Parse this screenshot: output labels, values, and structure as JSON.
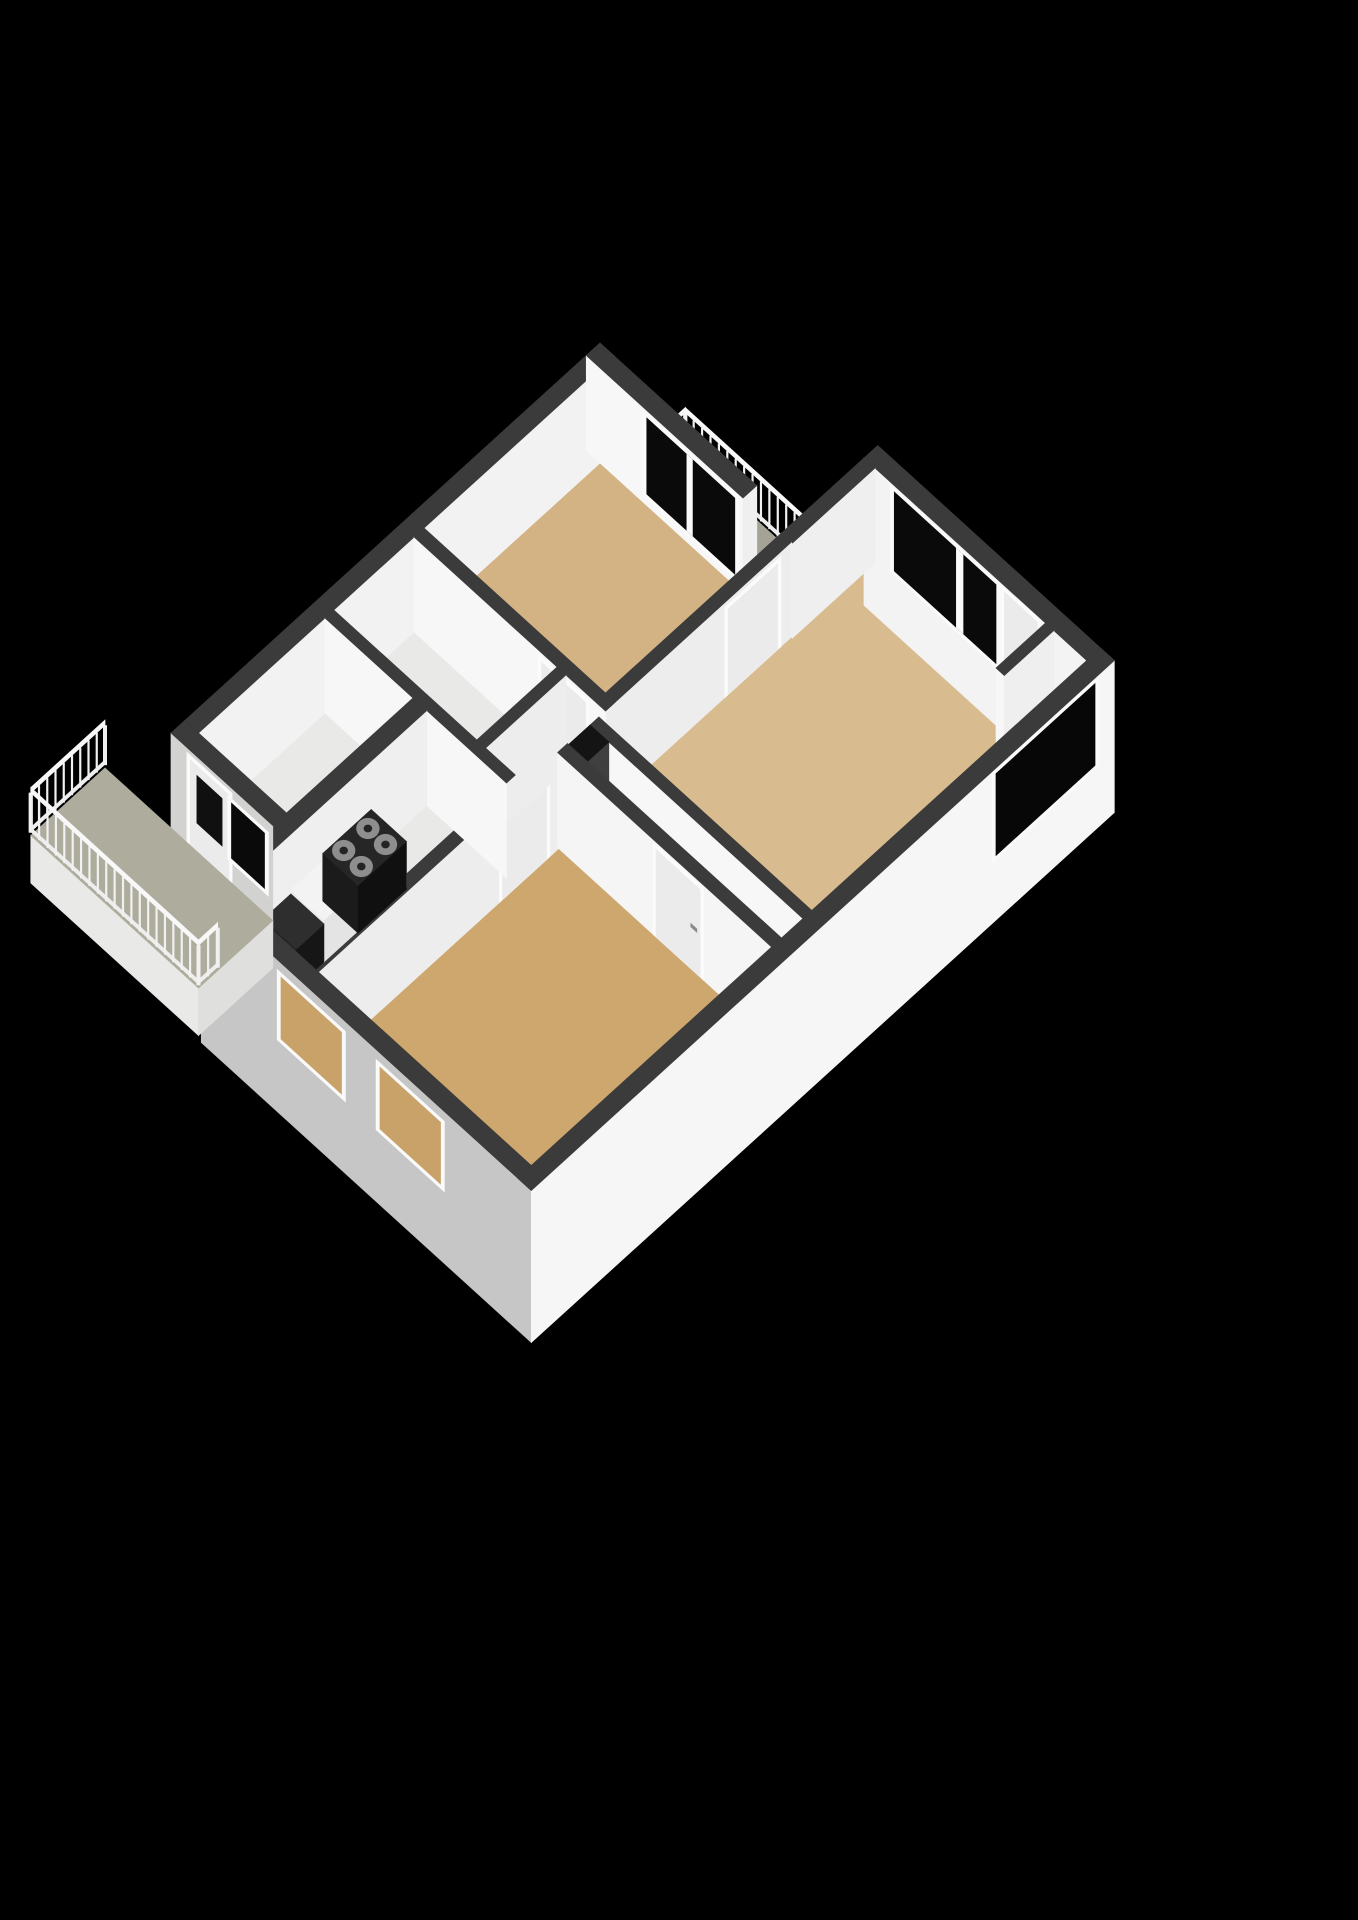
{
  "meta": {
    "kind": "3d-floor-plan-rendering",
    "background_color": "#000000",
    "canvas_width": 1358,
    "canvas_height": 1920,
    "style": "isometric cutaway apartment floor plan, white walls with dark-gray cut tops, tan wood floors, black background, no text labels"
  },
  "scene_description": {
    "rooms": [
      {
        "id": "bedroom-1",
        "floor_color": "#d3b383",
        "features": [
          "window-wall to top balcony"
        ]
      },
      {
        "id": "living-room",
        "floor_color": "#d8bb8e",
        "features": [
          "large dark window",
          "balcony door",
          "niche"
        ]
      },
      {
        "id": "hall",
        "floor_color": "#cfa976",
        "features": [
          "entrance door",
          "shaft"
        ]
      },
      {
        "id": "bedroom-2",
        "floor_color": "#cda76e",
        "features": [
          "two windows in sw facade"
        ]
      },
      {
        "id": "kitchen",
        "floor_color": "#e9e9e7",
        "features": [
          "counter",
          "4-burner stove",
          "dark worktop"
        ]
      },
      {
        "id": "bathroom",
        "floor_color": "#e9e9e7",
        "features": []
      },
      {
        "id": "toilet",
        "floor_color": "#e9e9e7",
        "features": []
      },
      {
        "id": "utility-room",
        "floor_color": "#e9e9e7",
        "features": [
          "door and window to sw balcony"
        ]
      },
      {
        "id": "balcony-top",
        "floor_color": "#a5a396",
        "features": [
          "white baluster railing"
        ]
      },
      {
        "id": "balcony-sw",
        "floor_color": "#aeac9d",
        "features": [
          "white baluster railing on three sides"
        ]
      }
    ]
  },
  "palette": {
    "background": "#000000",
    "wall_top": "#3b3b3b",
    "wall_inner_bright": "#f7f7f7",
    "wall_inner_dim": "#ededed",
    "wall_exterior_light": "#f6f6f6",
    "wall_exterior_gray": "#c6c6c6",
    "floor_tan": "#d3b383",
    "floor_gray": "#e9e9e7",
    "balcony_floor": "#aeac9d",
    "window_glass": "#0a0a0a",
    "window_tan_glass": "#c9a269",
    "frame_white": "#fafafa",
    "door_panel": "#ebebeb",
    "railing": "#f1f1f1",
    "stove_body": "#1b1b1b",
    "burner": "#8e8e8e"
  },
  "render": {
    "projection": {
      "origin_x": 600,
      "origin_y": 463,
      "ax": 55,
      "ay": 50,
      "wall_px": 95
    },
    "rail_height": 0.45,
    "elements": [
      {
        "t": "face",
        "side": "v",
        "at": -0.85,
        "a": [
          0.7,
          3.3
        ],
        "z": [
          -0.45,
          0
        ],
        "c": "#e9e9e7",
        "name": "balcony-top-fascia"
      },
      {
        "t": "face",
        "side": "u",
        "at": 3.3,
        "a": [
          -0.85,
          0
        ],
        "z": [
          -0.45,
          0
        ],
        "c": "#dcdcda",
        "name": "balcony-top-fascia-side"
      },
      {
        "t": "floor",
        "r": [
          0.7,
          -0.85,
          3.3,
          0
        ],
        "c": "#a5a396",
        "name": "balcony-top-floor"
      },
      {
        "t": "rail",
        "a": [
          0.7,
          -0.85
        ],
        "b": [
          0.7,
          0
        ],
        "name": "balcony-top-railing-nw"
      },
      {
        "t": "rail",
        "a": [
          0.7,
          -0.85
        ],
        "b": [
          3.3,
          -0.85
        ],
        "name": "balcony-top-railing-ne"
      },
      {
        "t": "floor",
        "r": [
          0,
          0,
          3.3,
          3.2
        ],
        "c": "#d3b383",
        "name": "bedroom-1-floor"
      },
      {
        "t": "floor",
        "r": [
          3.48,
          -1.5,
          7.35,
          3.5
        ],
        "c": "#d8bb8e",
        "name": "living-room-floor"
      },
      {
        "t": "floor",
        "r": [
          6.75,
          -1.5,
          7.35,
          -0.6
        ],
        "c": "#e3e3e1",
        "name": "living-room-niche-floor"
      },
      {
        "t": "floor",
        "r": [
          0,
          3.38,
          2.6,
          4.84
        ],
        "c": "#e9e9e7",
        "name": "bathroom-floor"
      },
      {
        "t": "floor",
        "r": [
          2.76,
          3.38,
          3.3,
          4.84
        ],
        "c": "#e9e9e7",
        "name": "toilet-floor"
      },
      {
        "t": "floor",
        "r": [
          0,
          5.0,
          1.6,
          7.3
        ],
        "c": "#e9e9e7",
        "name": "utility-room-floor"
      },
      {
        "t": "floor",
        "r": [
          1.85,
          5.0,
          3.3,
          8.6
        ],
        "c": "#e9e9e7",
        "name": "kitchen-floor"
      },
      {
        "t": "floor",
        "r": [
          3.48,
          3.38,
          7.35,
          4.05
        ],
        "c": "#cfa976",
        "name": "hall-floor"
      },
      {
        "t": "floor",
        "r": [
          3.48,
          4.23,
          7.35,
          8.6
        ],
        "c": "#cda76e",
        "name": "bedroom-2-floor"
      },
      {
        "t": "block",
        "r": [
          -0.25,
          -0.25,
          0,
          7.3
        ],
        "z": [
          0,
          1
        ],
        "su": "#f2f2f2",
        "top": "#3b3b3b",
        "name": "wall-nw-exterior"
      },
      {
        "t": "block",
        "r": [
          -0.25,
          -0.25,
          2.6,
          0
        ],
        "z": [
          0,
          1
        ],
        "sv": "#f7f7f7",
        "su": "#efefef",
        "top": "#3b3b3b",
        "name": "wall-bedroom1-ne"
      },
      {
        "t": "window",
        "side": "v",
        "at": 0,
        "a": [
          0.85,
          2.45
        ],
        "z": [
          0.12,
          0.92
        ],
        "glass": "#0a0a0a",
        "mullions": [
          [
            1.58,
            1.68
          ]
        ],
        "name": "window-bedroom-1-balcony"
      },
      {
        "t": "block",
        "r": [
          3.3,
          -1.75,
          7.6,
          -1.5
        ],
        "z": [
          -0.55,
          1
        ],
        "sv": "#f3f3f3",
        "top": "#3b3b3b",
        "name": "wall-living-ne"
      },
      {
        "t": "window",
        "side": "v",
        "at": -1.5,
        "a": [
          3.85,
          5.7
        ],
        "z": [
          0.1,
          0.93
        ],
        "glass": "#0a0a0a",
        "mullions": [
          [
            4.98,
            5.1
          ]
        ],
        "name": "window-living-room-large"
      },
      {
        "t": "door",
        "side": "v",
        "at": -1.5,
        "a": [
          5.85,
          6.45
        ],
        "h": 0.93,
        "handle": true,
        "name": "door-living-room-balcony"
      },
      {
        "t": "block",
        "r": [
          3.3,
          -1.5,
          3.5,
          0
        ],
        "z": [
          0,
          1
        ],
        "sv": "#f7f7f7",
        "su": "#efefef",
        "top": "#3b3b3b",
        "name": "wall-living-nw-stub"
      },
      {
        "t": "block",
        "r": [
          6.6,
          -1.5,
          6.75,
          -0.6
        ],
        "z": [
          0,
          1
        ],
        "sv": "#f7f7f7",
        "su": "#efefef",
        "top": "#3b3b3b",
        "name": "wall-niche-stub"
      },
      {
        "t": "block",
        "r": [
          3.3,
          0,
          3.48,
          8.6
        ],
        "z": [
          0,
          1
        ],
        "su": "#ededed",
        "top": "#3b3b3b",
        "name": "wall-central-spine"
      },
      {
        "t": "door",
        "side": "u",
        "at": 3.48,
        "a": [
          0.25,
          1.15
        ],
        "h": 0.9,
        "name": "door-living-room"
      },
      {
        "t": "door",
        "side": "u",
        "at": 3.48,
        "a": [
          4.45,
          5.25
        ],
        "h": 0.9,
        "name": "door-kitchen"
      },
      {
        "t": "block",
        "r": [
          0,
          3.2,
          3.48,
          3.38
        ],
        "z": [
          0,
          1
        ],
        "sv": "#f7f7f7",
        "top": "#3b3b3b",
        "name": "wall-bedroom1-sw"
      },
      {
        "t": "door",
        "side": "v",
        "at": 3.38,
        "a": [
          2.32,
          3.12
        ],
        "h": 0.9,
        "name": "door-bedroom-1"
      },
      {
        "t": "block",
        "r": [
          2.6,
          3.38,
          2.76,
          4.84
        ],
        "z": [
          0,
          1
        ],
        "su": "#ededed",
        "top": "#3b3b3b",
        "name": "wall-bathroom-toilet"
      },
      {
        "t": "block",
        "r": [
          0,
          4.84,
          3.3,
          5.0
        ],
        "z": [
          0,
          1
        ],
        "sv": "#f7f7f7",
        "top": "#3b3b3b",
        "name": "wall-bathroom-south"
      },
      {
        "t": "block",
        "r": [
          1.6,
          5.0,
          1.85,
          8.6
        ],
        "z": [
          0,
          1
        ],
        "su": "#efefef",
        "top": "#3b3b3b",
        "name": "wall-kitchen-west"
      },
      {
        "t": "block",
        "r": [
          1.88,
          6.0,
          2.48,
          7.5
        ],
        "z": [
          0,
          0.44
        ],
        "su": "#e4e4e4",
        "sv": "#ececec",
        "top": "#f3f3f3",
        "name": "kitchen-counter"
      },
      {
        "t": "block",
        "r": [
          1.86,
          6.02,
          2.5,
          6.9
        ],
        "z": [
          0,
          0.5
        ],
        "su": "#101010",
        "sv": "#1b1b1b",
        "top": "#262626",
        "name": "stove"
      },
      {
        "t": "circle",
        "u": 2.02,
        "v": 6.24,
        "z": 0.5,
        "rad": 0.15,
        "c": "#8e8e8e",
        "name": "stove-burner"
      },
      {
        "t": "circle",
        "u": 2.02,
        "v": 6.24,
        "z": 0.5,
        "rad": 0.055,
        "c": "#242424",
        "name": "stove-burner-center"
      },
      {
        "t": "circle",
        "u": 2.34,
        "v": 6.24,
        "z": 0.5,
        "rad": 0.15,
        "c": "#8e8e8e",
        "name": "stove-burner"
      },
      {
        "t": "circle",
        "u": 2.34,
        "v": 6.24,
        "z": 0.5,
        "rad": 0.055,
        "c": "#242424",
        "name": "stove-burner-center"
      },
      {
        "t": "circle",
        "u": 2.02,
        "v": 6.68,
        "z": 0.5,
        "rad": 0.15,
        "c": "#8e8e8e",
        "name": "stove-burner"
      },
      {
        "t": "circle",
        "u": 2.02,
        "v": 6.68,
        "z": 0.5,
        "rad": 0.055,
        "c": "#242424",
        "name": "stove-burner-center"
      },
      {
        "t": "circle",
        "u": 2.34,
        "v": 6.68,
        "z": 0.5,
        "rad": 0.15,
        "c": "#8e8e8e",
        "name": "stove-burner"
      },
      {
        "t": "circle",
        "u": 2.34,
        "v": 6.68,
        "z": 0.5,
        "rad": 0.055,
        "c": "#242424",
        "name": "stove-burner-center"
      },
      {
        "t": "block",
        "r": [
          1.88,
          7.5,
          2.48,
          8.0
        ],
        "z": [
          0,
          0.4
        ],
        "su": "#161616",
        "sv": "#242424",
        "top": "#2e2e2e",
        "name": "kitchen-counter-dark"
      },
      {
        "t": "block",
        "r": [
          -0.25,
          7.3,
          1.6,
          7.55
        ],
        "z": [
          -0.55,
          1
        ],
        "sv": "#d2d2d0",
        "top": "#3b3b3b",
        "name": "wall-utility-sw"
      },
      {
        "t": "door",
        "side": "v",
        "at": 7.55,
        "a": [
          0.1,
          0.8
        ],
        "h": 0.9,
        "glass": [
          0.3,
          0.8
        ],
        "name": "door-balcony-sw"
      },
      {
        "t": "window",
        "side": "v",
        "at": 7.55,
        "a": [
          0.85,
          1.45
        ],
        "z": [
          0.26,
          0.84
        ],
        "glass": "#0a0a0a",
        "name": "window-utility"
      },
      {
        "t": "block",
        "r": [
          1.6,
          8.6,
          7.6,
          8.85
        ],
        "z": [
          -0.6,
          1
        ],
        "sv": "#c6c6c6",
        "top": "#3b3b3b",
        "name": "wall-sw-exterior"
      },
      {
        "t": "window",
        "side": "v",
        "at": 8.85,
        "a": [
          3.05,
          4.15
        ],
        "z": [
          0.2,
          0.85
        ],
        "glass": "#c9a269",
        "name": "window-bedroom-2-a"
      },
      {
        "t": "window",
        "side": "v",
        "at": 8.85,
        "a": [
          4.85,
          5.95
        ],
        "z": [
          0.2,
          0.85
        ],
        "glass": "#c9a269",
        "name": "window-bedroom-2-b"
      },
      {
        "t": "block",
        "r": [
          3.48,
          3.5,
          7.35,
          3.66
        ],
        "z": [
          0,
          1
        ],
        "sv": "#f7f7f7",
        "top": "#3b3b3b",
        "name": "wall-living-sw"
      },
      {
        "t": "block",
        "r": [
          3.48,
          3.66,
          3.82,
          4.05
        ],
        "z": [
          0,
          1
        ],
        "sv": "#4a4a4a",
        "su": "#3f3f3f",
        "top": "#141414",
        "name": "shaft"
      },
      {
        "t": "block",
        "r": [
          3.46,
          4.05,
          7.35,
          4.23
        ],
        "z": [
          0,
          1
        ],
        "sv": "#f5f5f5",
        "top": "#3b3b3b",
        "name": "wall-bedroom2-nw"
      },
      {
        "t": "door",
        "side": "v",
        "at": 4.23,
        "a": [
          5.25,
          6.05
        ],
        "h": 0.92,
        "handle": true,
        "name": "door-entrance"
      },
      {
        "t": "block",
        "r": [
          7.35,
          -1.75,
          7.6,
          8.85
        ],
        "z": [
          -0.6,
          1
        ],
        "su": "#f6f6f6",
        "top": "#3b3b3b",
        "name": "wall-se-exterior"
      },
      {
        "t": "window",
        "side": "u",
        "at": 7.6,
        "a": [
          -1.4,
          0.4
        ],
        "z": [
          0.08,
          0.94
        ],
        "glass": "#070707",
        "name": "window-living-room-se"
      },
      {
        "t": "face",
        "side": "v",
        "at": 8.9,
        "a": [
          -1.45,
          1.6
        ],
        "z": [
          -0.5,
          0
        ],
        "c": "#e9e9e7",
        "name": "balcony-sw-fascia"
      },
      {
        "t": "face",
        "side": "u",
        "at": 1.6,
        "a": [
          7.55,
          8.9
        ],
        "z": [
          -0.5,
          0
        ],
        "c": "#dfdfdd",
        "name": "balcony-sw-fascia-side"
      },
      {
        "t": "floor",
        "r": [
          -1.45,
          7.55,
          1.6,
          8.9
        ],
        "c": "#aeac9d",
        "name": "balcony-sw-floor"
      },
      {
        "t": "rail",
        "a": [
          -1.45,
          7.55
        ],
        "b": [
          -1.45,
          8.9
        ],
        "name": "balcony-sw-railing-nw"
      },
      {
        "t": "rail",
        "a": [
          -1.45,
          8.9
        ],
        "b": [
          1.6,
          8.9
        ],
        "name": "balcony-sw-railing-sw"
      },
      {
        "t": "rail",
        "a": [
          1.6,
          8.55
        ],
        "b": [
          1.6,
          8.9
        ],
        "name": "balcony-sw-railing-se"
      }
    ]
  }
}
